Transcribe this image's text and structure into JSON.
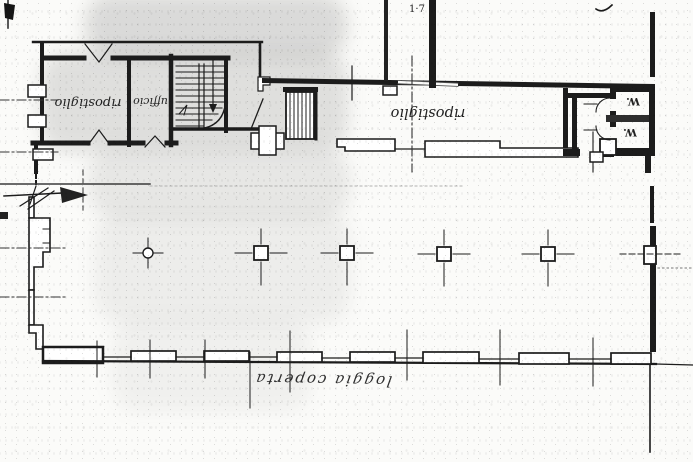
{
  "document": {
    "type": "scanned architectural floor plan",
    "labels": {
      "storage_room": "ripostiglio",
      "office_room": "ufficio",
      "corridor_storage": "ripostiglio",
      "wc_upper": "W.",
      "wc_lower": "W.",
      "loggia_handwritten": "loggia coperta",
      "top_annotation": "1·7"
    },
    "colors": {
      "paper": "#fbfbf9",
      "ink": "#1c1c1c",
      "scan_shade": "#8a8a8a",
      "faint_line": "#b0b0b0"
    },
    "features": {
      "square_columns": 4,
      "round_column_markers": 1,
      "wc_rooms": 2,
      "staircases": 2
    }
  }
}
